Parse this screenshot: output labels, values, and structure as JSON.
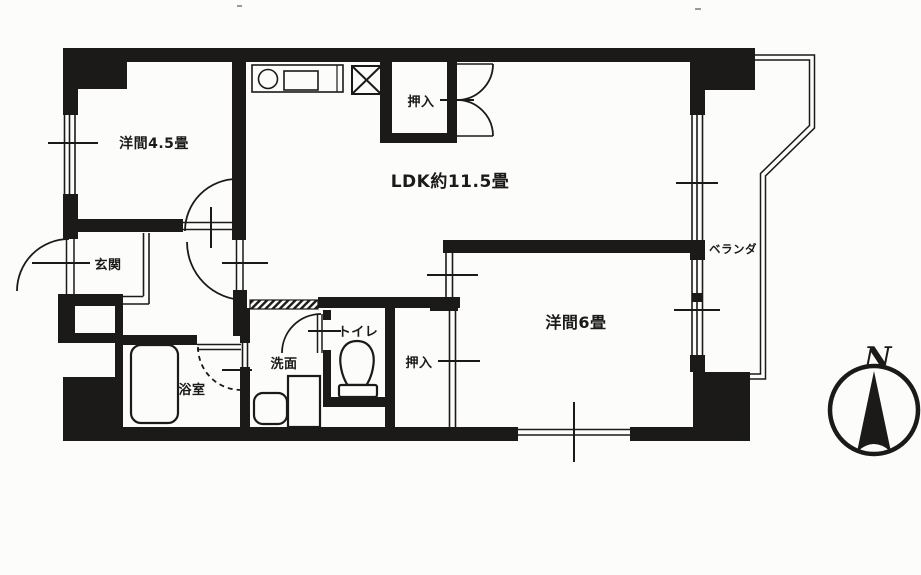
{
  "document": {
    "kind": "japanese-apartment-floor-plan-scan",
    "ink_color": "#1c1a18",
    "background_color": "#fcfcfb"
  },
  "rooms": [
    {
      "id": "western-room-4-5",
      "label": "洋間4.5畳"
    },
    {
      "id": "ldk",
      "label": "LDK約11.5畳"
    },
    {
      "id": "closet-top",
      "label": "押入"
    },
    {
      "id": "veranda",
      "label": "ベランダ"
    },
    {
      "id": "western-room-6",
      "label": "洋間6畳"
    },
    {
      "id": "entrance",
      "label": "玄関"
    },
    {
      "id": "bathroom",
      "label": "浴室"
    },
    {
      "id": "washroom",
      "label": "洗面"
    },
    {
      "id": "toilet",
      "label": "トイレ"
    },
    {
      "id": "closet-bottom",
      "label": "押入"
    }
  ],
  "compass": {
    "letter": "N",
    "direction": "up"
  },
  "fixtures": [
    "kitchen-counter",
    "kitchen-sink",
    "stove",
    "refrigerator-space",
    "bathtub",
    "toilet-bowl",
    "washing-machine-space",
    "wash-basin",
    "balcony-railing",
    "entry-step"
  ]
}
